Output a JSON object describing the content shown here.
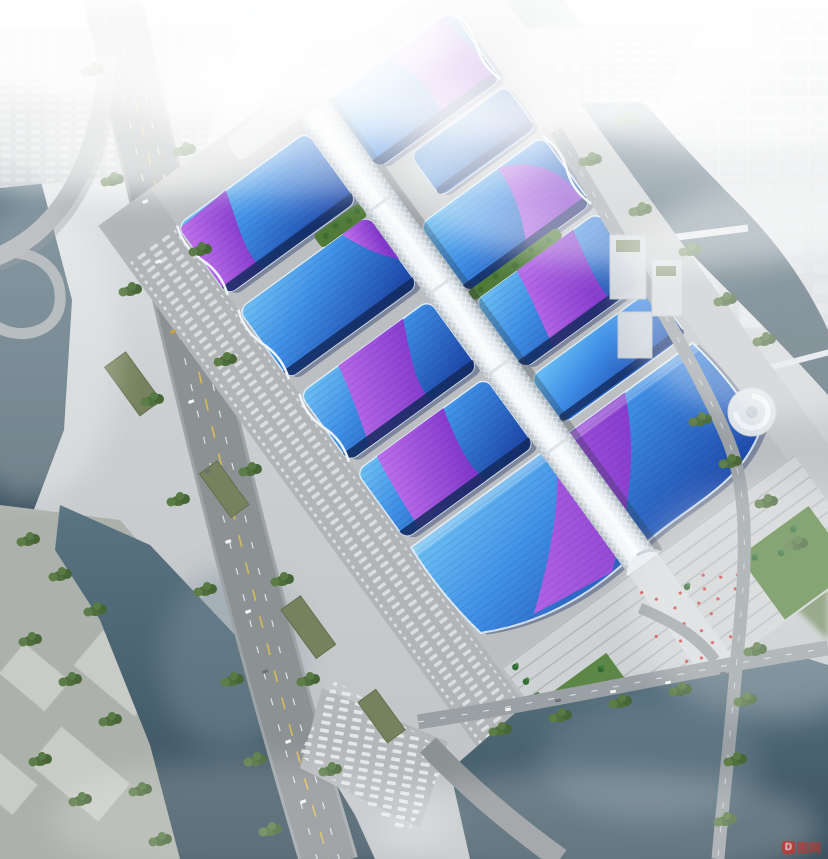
{
  "watermark": {
    "logo": "D",
    "text": "图网"
  },
  "palette": {
    "roof_blue_light": "#6ec2f4",
    "roof_blue_mid": "#3e8ee6",
    "roof_blue_deep": "#1d47a8",
    "roof_edge_navy": "#132a5e",
    "ribbon_purple_light": "#c273ee",
    "ribbon_purple_deep": "#8338cc",
    "corridor_white": "#eef3f6",
    "water_dark": "#3c5260",
    "water_teal": "#5a7482",
    "ground_gray": "#bcbfc1",
    "road_gray": "#8c9194",
    "lane_yellow": "#d9bb55",
    "foliage_green": "#4e6e3c",
    "lawn_green": "#5d8747",
    "haze_white": "#f2f5f6",
    "crowd_red": "#cf3a30"
  }
}
